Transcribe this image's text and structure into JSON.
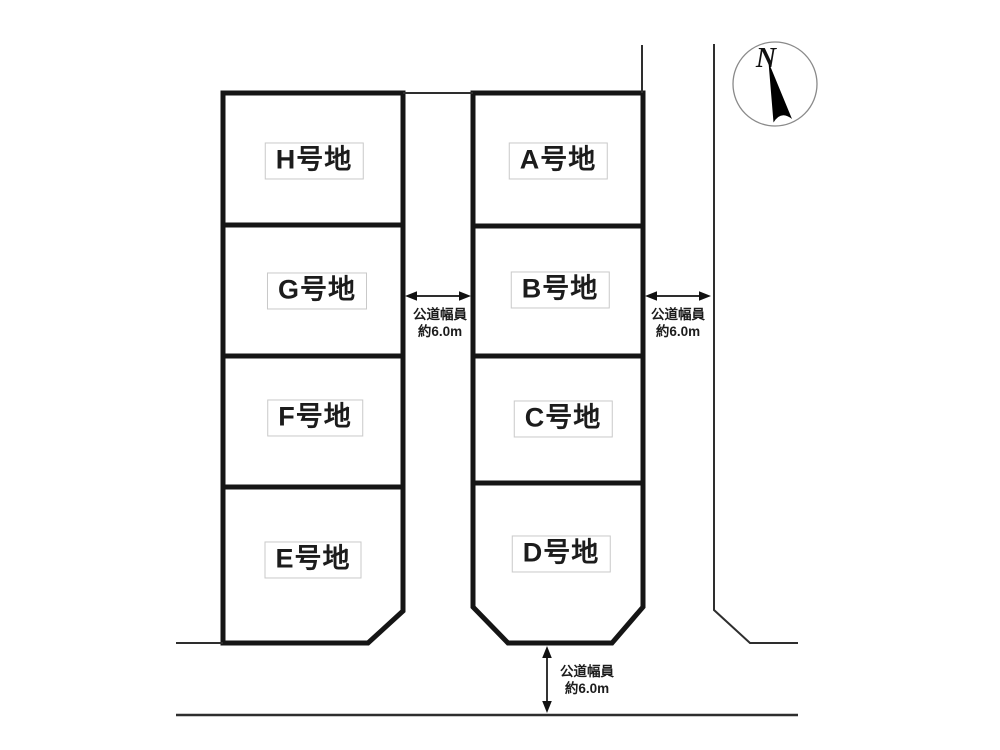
{
  "diagram_title": "lot-subdivision-plan",
  "compass": {
    "label": "N"
  },
  "lots": [
    {
      "id": "H",
      "label": "H号地"
    },
    {
      "id": "G",
      "label": "G号地"
    },
    {
      "id": "F",
      "label": "F号地"
    },
    {
      "id": "E",
      "label": "E号地"
    },
    {
      "id": "A",
      "label": "A号地"
    },
    {
      "id": "B",
      "label": "B号地"
    },
    {
      "id": "C",
      "label": "C号地"
    },
    {
      "id": "D",
      "label": "D号地"
    }
  ],
  "roads": [
    {
      "id": "center-road",
      "line1": "公道幅員",
      "line2": "約6.0m",
      "orientation": "vertical-road-horizontal-arrow"
    },
    {
      "id": "east-road",
      "line1": "公道幅員",
      "line2": "約6.0m",
      "orientation": "vertical-road-horizontal-arrow"
    },
    {
      "id": "south-road",
      "line1": "公道幅員",
      "line2": "約6.0m",
      "orientation": "horizontal-road-vertical-arrow"
    }
  ],
  "colors": {
    "background": "#ffffff",
    "lot_stroke": "#151515",
    "thin_line": "#2e2e2e",
    "label_border": "#c9c9c9",
    "needle_fill": "#000000"
  }
}
